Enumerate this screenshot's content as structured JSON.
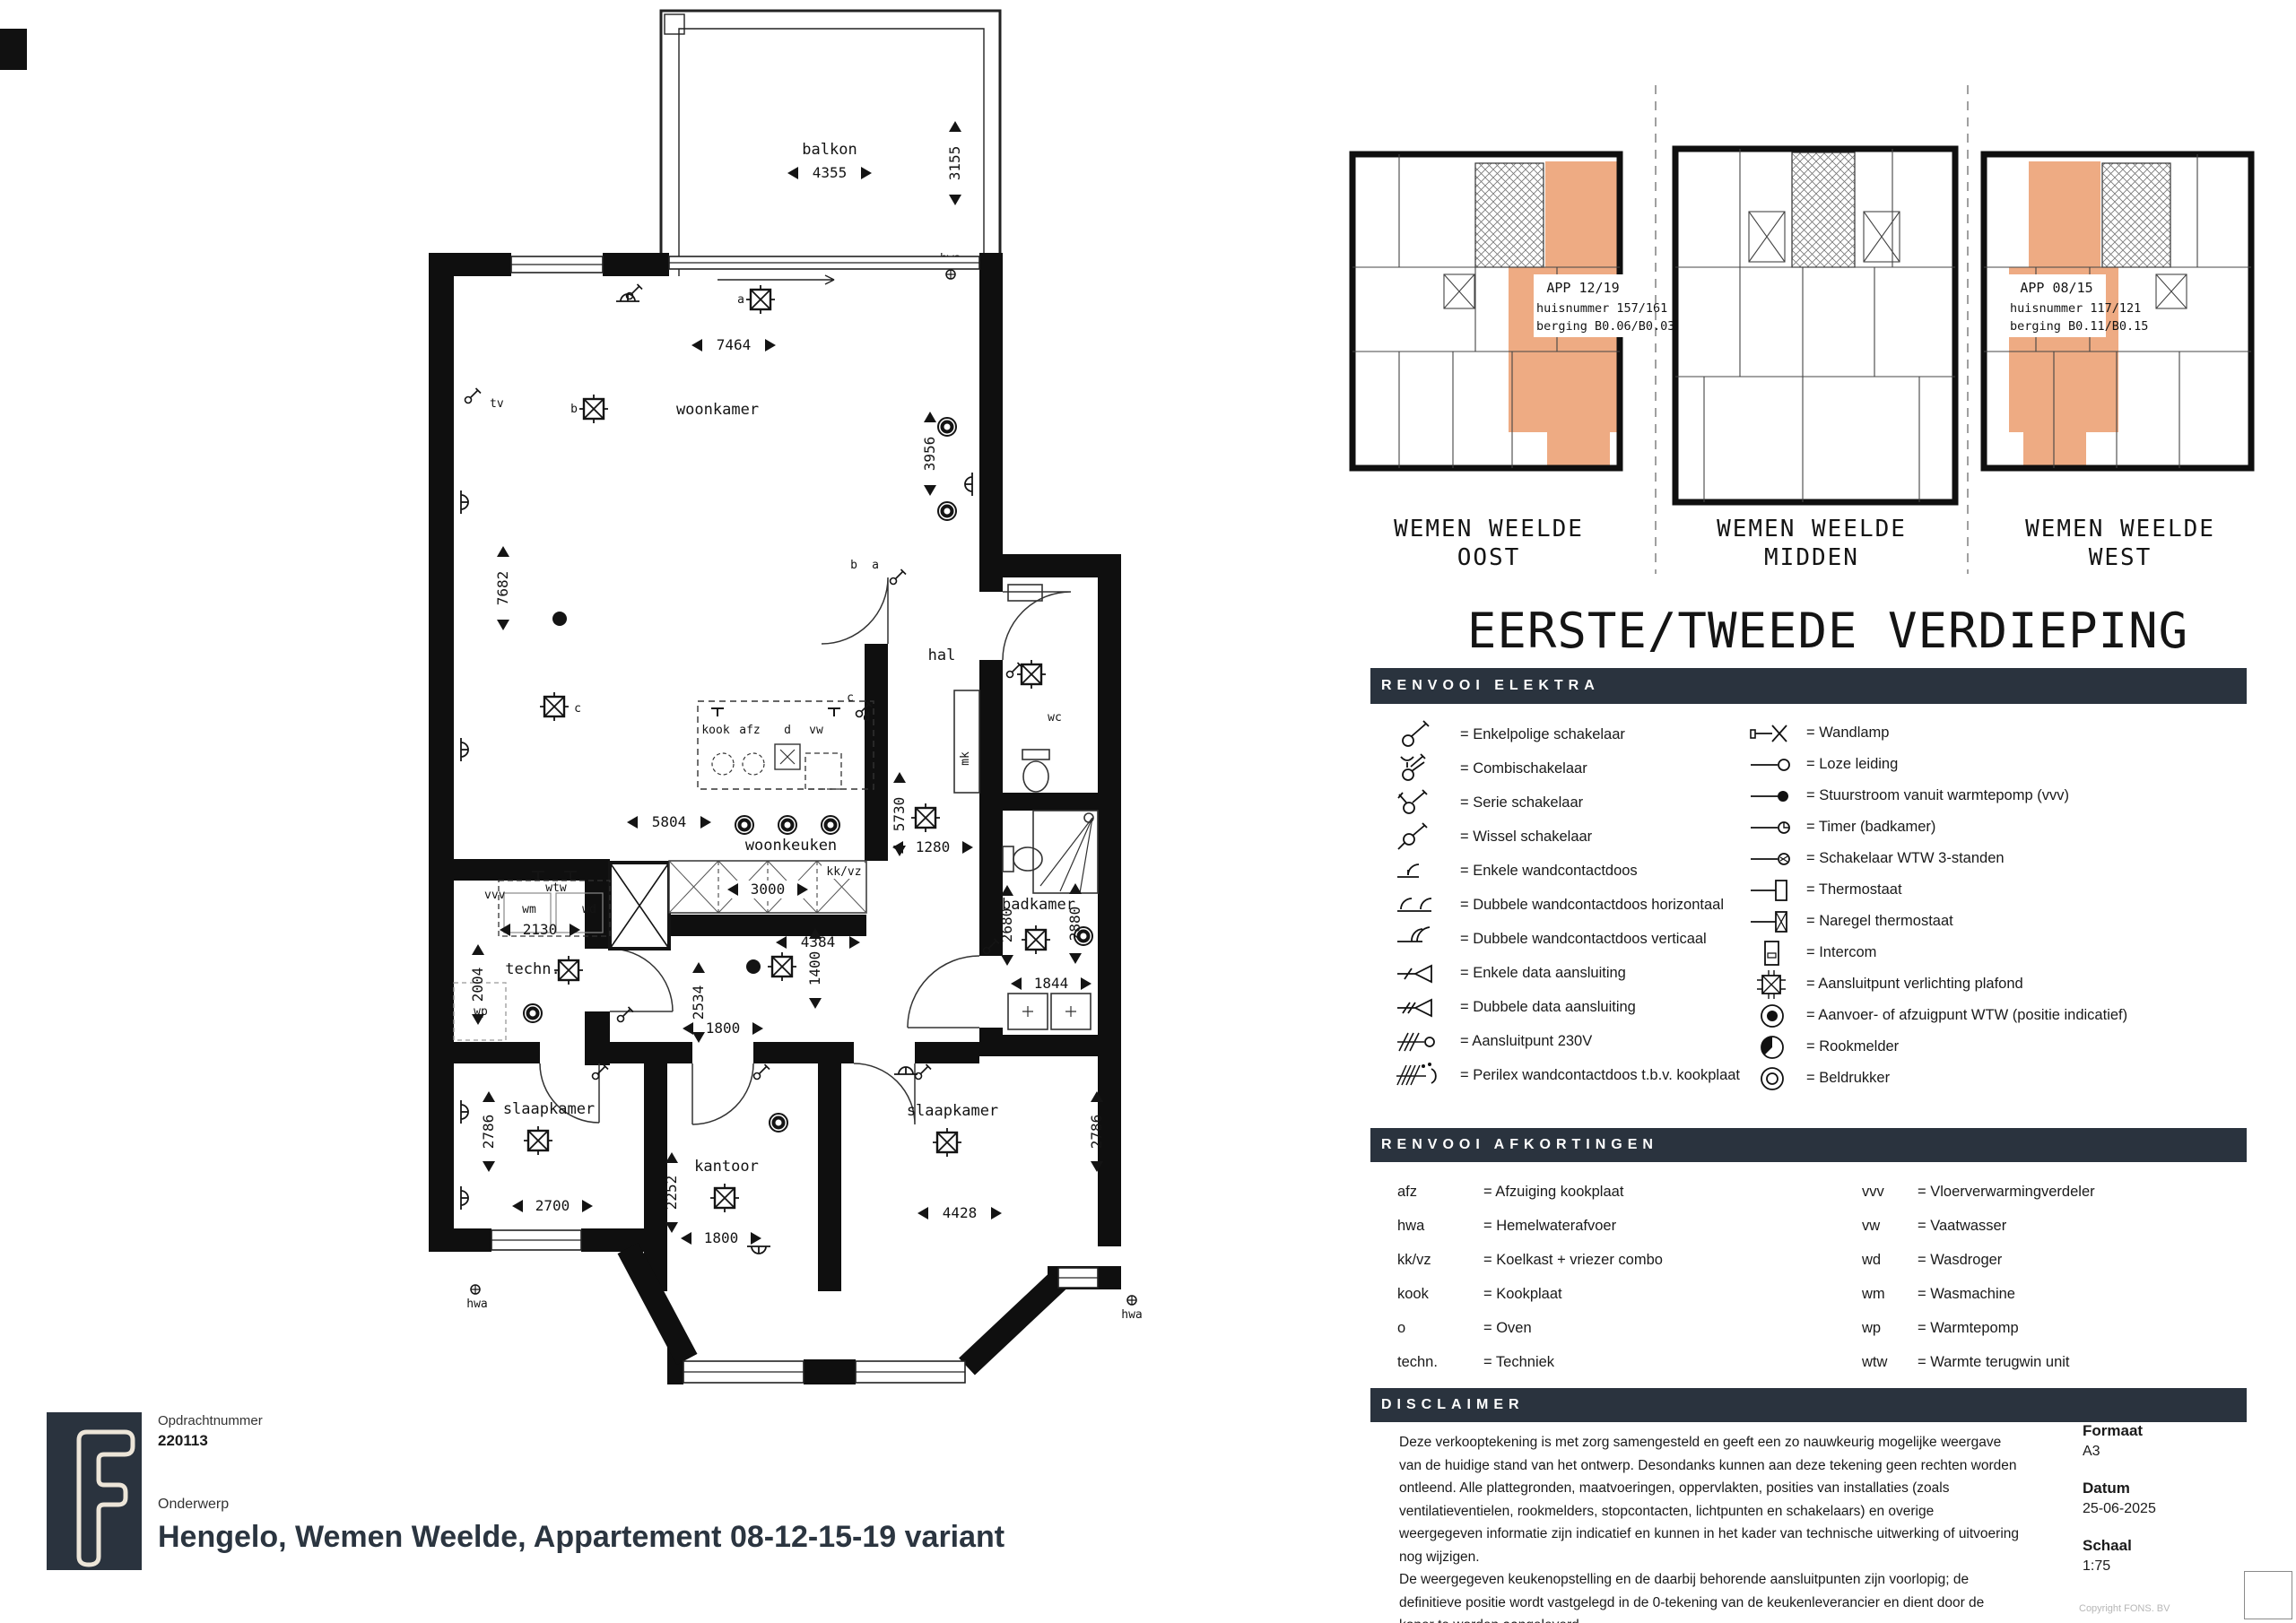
{
  "title_block": {
    "logo_letter": "F",
    "opdrachtnummer_label": "Opdrachtnummer",
    "opdrachtnummer": "220113",
    "onderwerp_label": "Onderwerp",
    "onderwerp": "Hengelo, Wemen Weelde, Appartement 08-12-15-19 variant"
  },
  "info": {
    "formaat_label": "Formaat",
    "formaat": "A3",
    "datum_label": "Datum",
    "datum": "25-06-2025",
    "schaal_label": "Schaal",
    "schaal": "1:75",
    "copyright": "Copyright FONS. BV"
  },
  "overview": {
    "floor_title": "EERSTE/TWEEDE VERDIEPING",
    "sections": [
      {
        "line1": "WEMEN WEELDE",
        "line2": "OOST"
      },
      {
        "line1": "WEMEN WEELDE",
        "line2": "MIDDEN"
      },
      {
        "line1": "WEMEN WEELDE",
        "line2": "WEST"
      }
    ],
    "apartments": [
      {
        "app": "APP 12/19",
        "huisnummer": "huisnummer 157/161",
        "berging": "berging B0.06/B0.03"
      },
      {
        "app": "APP 08/15",
        "huisnummer": "huisnummer 117/121",
        "berging": "berging B0.11/B0.15"
      }
    ],
    "highlight_color": "#eeab83"
  },
  "floorplan": {
    "rooms": {
      "balkon": "balkon",
      "woonkamer": "woonkamer",
      "woonkeuken": "woonkeuken",
      "hal": "hal",
      "wc": "wc",
      "mk": "mk",
      "badkamer": "badkamer",
      "techn": "techn.",
      "slaapkamer": "slaapkamer",
      "kantoor": "kantoor"
    },
    "labels": {
      "tv": "tv",
      "kook": "kook",
      "afz": "afz",
      "d": "d",
      "vw": "vw",
      "kkvz": "kk/vz",
      "vvv": "vvv",
      "wtw": "wtw",
      "wm": "wm",
      "wd": "wd",
      "wp": "wp",
      "hwa": "hwa"
    },
    "switch_letters": {
      "a": "a",
      "b": "b",
      "c": "c",
      "d": "d"
    },
    "dimensions": {
      "balkon_w": "4355",
      "balkon_h": "3155",
      "woonkamer_w": "7464",
      "woonkamer_h": "7682",
      "woonkamer_h2": "3956",
      "woonkeuken_w": "5804",
      "hal_h": "5730",
      "hal_w": "1280",
      "kitchen_w": "3000",
      "woonkeuken_w2": "4384",
      "techn_w": "2130",
      "techn_h": "2004",
      "corridor_h": "2534",
      "corridor_w": "1400",
      "hal_door": "1800",
      "badkamer_h_left": "2680",
      "badkamer_h_right": "2880",
      "badkamer_w": "1844",
      "slaapkamer_l_h": "2786",
      "slaapkamer_l_w": "2700",
      "kantoor_h": "2252",
      "kantoor_w": "1800",
      "slaapkamer_r_w": "4428",
      "slaapkamer_r_h": "2786"
    }
  },
  "legend_elektra": {
    "title": "RENVOOI ELEKTRA",
    "left": [
      {
        "sym": "enkelpolige-schakelaar",
        "label": "= Enkelpolige schakelaar"
      },
      {
        "sym": "combischakelaar",
        "label": "= Combischakelaar"
      },
      {
        "sym": "serie-schakelaar",
        "label": "= Serie schakelaar"
      },
      {
        "sym": "wissel-schakelaar",
        "label": "= Wissel schakelaar"
      },
      {
        "sym": "enkele-wandcontactdoos",
        "label": "= Enkele wandcontactdoos"
      },
      {
        "sym": "dubbele-wandcontactdoos-horizontaal",
        "label": "= Dubbele wandcontactdoos horizontaal"
      },
      {
        "sym": "dubbele-wandcontactdoos-verticaal",
        "label": "= Dubbele wandcontactdoos verticaal"
      },
      {
        "sym": "enkele-data-aansluiting",
        "label": "= Enkele data aansluiting"
      },
      {
        "sym": "dubbele-data-aansluiting",
        "label": "= Dubbele data aansluiting"
      },
      {
        "sym": "aansluitpunt-230v",
        "label": "= Aansluitpunt 230V"
      },
      {
        "sym": "perilex-wandcontactdoos",
        "label": "= Perilex wandcontactdoos t.b.v. kookplaat"
      }
    ],
    "right": [
      {
        "sym": "wandlamp",
        "label": "= Wandlamp"
      },
      {
        "sym": "loze-leiding",
        "label": "= Loze leiding"
      },
      {
        "sym": "stuurstroom-warmtepomp",
        "label": "= Stuurstroom vanuit warmtepomp (vvv)"
      },
      {
        "sym": "timer-badkamer",
        "label": "= Timer (badkamer)"
      },
      {
        "sym": "schakelaar-wtw",
        "label": "= Schakelaar WTW 3-standen"
      },
      {
        "sym": "thermostaat",
        "label": "= Thermostaat"
      },
      {
        "sym": "naregel-thermostaat",
        "label": "= Naregel thermostaat"
      },
      {
        "sym": "intercom",
        "label": "= Intercom"
      },
      {
        "sym": "aansluitpunt-verlichting-plafond",
        "label": "= Aansluitpunt verlichting plafond"
      },
      {
        "sym": "wtw-punt",
        "label": "= Aanvoer- of afzuigpunt WTW (positie indicatief)"
      },
      {
        "sym": "rookmelder",
        "label": "= Rookmelder"
      },
      {
        "sym": "beldrukker",
        "label": "= Beldrukker"
      }
    ]
  },
  "legend_afkortingen": {
    "title": "RENVOOI AFKORTINGEN",
    "left": [
      {
        "abbr": "afz",
        "meaning": "= Afzuiging kookplaat"
      },
      {
        "abbr": "hwa",
        "meaning": "= Hemelwaterafvoer"
      },
      {
        "abbr": "kk/vz",
        "meaning": "= Koelkast + vriezer combo"
      },
      {
        "abbr": "kook",
        "meaning": "= Kookplaat"
      },
      {
        "abbr": "o",
        "meaning": "= Oven"
      },
      {
        "abbr": "techn.",
        "meaning": "= Techniek"
      }
    ],
    "right": [
      {
        "abbr": "vvv",
        "meaning": "= Vloerverwarmingverdeler"
      },
      {
        "abbr": "vw",
        "meaning": "= Vaatwasser"
      },
      {
        "abbr": "wd",
        "meaning": "= Wasdroger"
      },
      {
        "abbr": "wm",
        "meaning": "= Wasmachine"
      },
      {
        "abbr": "wp",
        "meaning": "= Warmtepomp"
      },
      {
        "abbr": "wtw",
        "meaning": "= Warmte terugwin unit"
      }
    ]
  },
  "disclaimer": {
    "title": "DISCLAIMER",
    "paragraph1": "Deze verkooptekening is met zorg samengesteld en geeft een zo nauwkeurig mogelijke weergave van de huidige stand van het ontwerp. Desondanks kunnen aan deze tekening geen rechten worden ontleend. Alle plattegronden, maatvoeringen, oppervlakten, posities van installaties (zoals ventilatieventielen, rookmelders, stopcontacten, lichtpunten en schakelaars) en overige weergegeven informatie zijn indicatief en kunnen in het kader van technische uitwerking of uitvoering nog wijzigen.",
    "paragraph2": "De weergegeven keukenopstelling en de daarbij behorende aansluitpunten zijn voorlopig; de definitieve positie wordt vastgelegd in de 0-tekening van de keukenleverancier en dient door de koper te worden aangeleverd."
  },
  "colors": {
    "navy": "#2a333e",
    "salmon": "#eeab83"
  }
}
